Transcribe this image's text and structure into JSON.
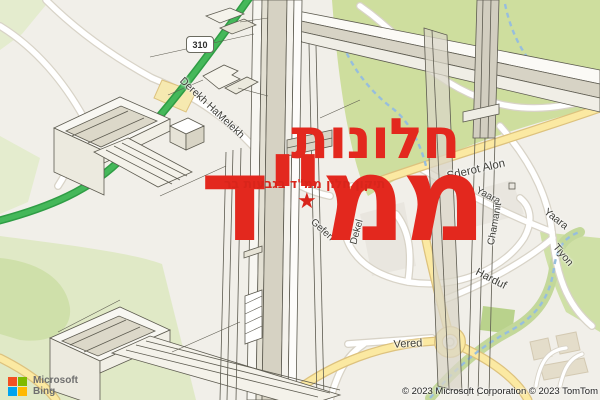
{
  "map": {
    "route_shield": "310",
    "street_labels": {
      "derekh_hamelekh": "Derekh HaMelekh",
      "sderot_alon": "Sderot Alon",
      "yaara_upper": "Yaara",
      "yaara_lower": "Yaara",
      "chamanit": "Chamanit",
      "tiyon": "Tiyon",
      "harduf": "Harduf",
      "gefen": "Gefen",
      "dekel": "Dekel",
      "vered": "Vered"
    }
  },
  "overlay": {
    "title_line1": "חלונות",
    "title_line2": "ממ\"ד",
    "subtitle": "תיקון חלון ממ\"ד בגבעות בר",
    "star_icon": "★",
    "accent_color": "#e3281e"
  },
  "branding": {
    "name_line1": "Microsoft",
    "name_line2": "Bing",
    "logo_colors": {
      "top_left": "#f25022",
      "top_right": "#7fba00",
      "bottom_left": "#00a4ef",
      "bottom_right": "#ffb900"
    }
  },
  "attribution": "© 2023 Microsoft Corporation © 2023 TomTom",
  "palette": {
    "park_green": "#cede9e",
    "highway_green": "#45b85a",
    "road_yellow": "#fbe9a2",
    "water_blue": "#97bedd"
  }
}
